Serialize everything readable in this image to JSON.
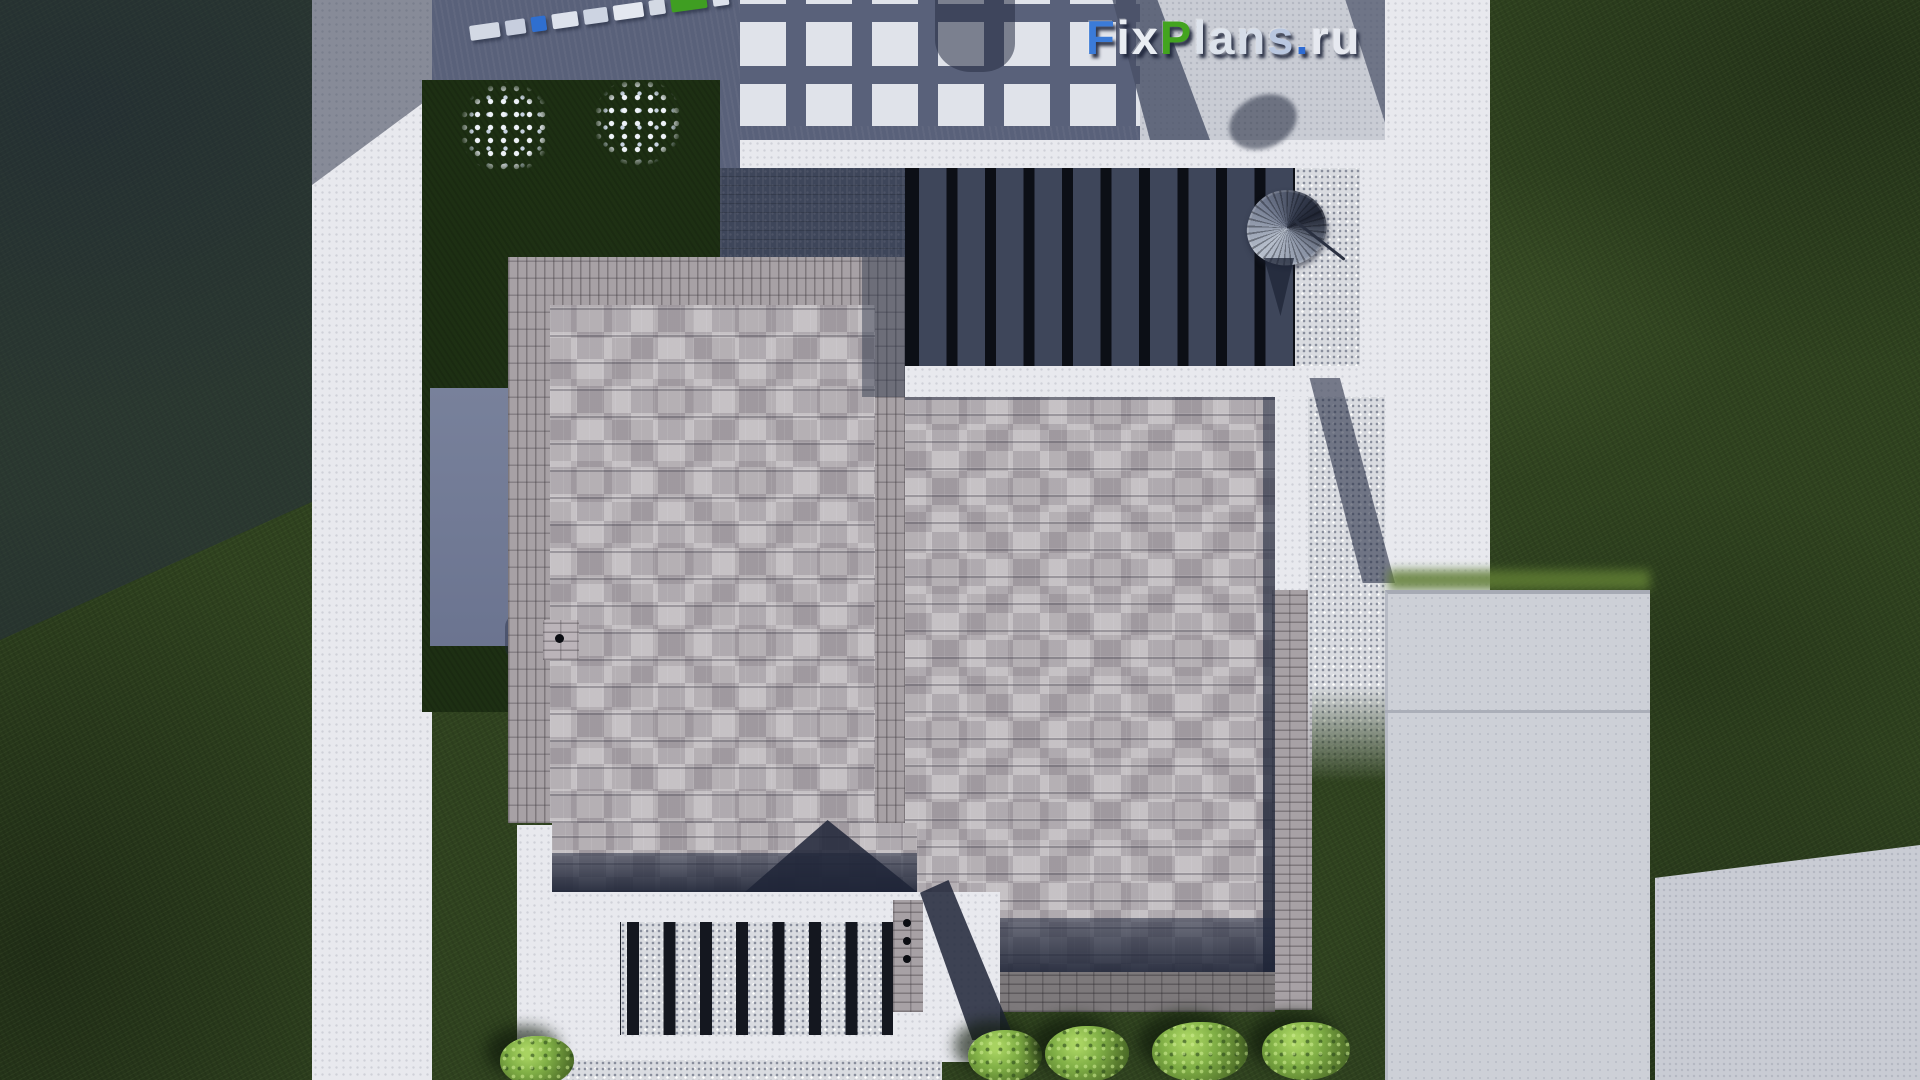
{
  "meta": {
    "description": "Top-down 3D render of a modern flat-roof house plan with pergola terraces, lawns and concrete paths",
    "source_watermark": "FixPlans.ru"
  },
  "watermark": {
    "text": "FixPlans.ru",
    "letters": [
      {
        "ch": "F",
        "color": "#3b7bd8"
      },
      {
        "ch": "i",
        "color": "#e9edf3"
      },
      {
        "ch": "x",
        "color": "#e9edf3"
      },
      {
        "ch": "P",
        "color": "#43a41f"
      },
      {
        "ch": "l",
        "color": "#dde3ec"
      },
      {
        "ch": "a",
        "color": "#dde3ec"
      },
      {
        "ch": "n",
        "color": "#d5dce8"
      },
      {
        "ch": "s",
        "color": "#b9c7e0"
      },
      {
        "ch": ".",
        "color": "#2e6bd2"
      },
      {
        "ch": "r",
        "color": "#e6e9f0"
      },
      {
        "ch": "u",
        "color": "#e6e9f0"
      }
    ],
    "shadow_color": "#1c2238"
  },
  "mini_watermark": {
    "tilt_deg": -8,
    "blocks": [
      {
        "w": 30,
        "color": "#d3d9e4"
      },
      {
        "w": 20,
        "color": "#c7cede"
      },
      {
        "w": 15,
        "color": "#2f6fd0"
      },
      {
        "w": 26,
        "color": "#dde2ec"
      },
      {
        "w": 24,
        "color": "#cdd4e2"
      },
      {
        "w": 30,
        "color": "#e4e8f0"
      },
      {
        "w": 16,
        "color": "#d3d9e4"
      },
      {
        "w": 36,
        "color": "#3f9e22"
      },
      {
        "w": 16,
        "color": "#dde2ec"
      }
    ]
  },
  "palette": {
    "lawn": "#2f421f",
    "lawn_shaded": "#1d2f13",
    "concrete_white": "#e8e9ee",
    "concrete_light": "#c9ccd4",
    "concrete_shadowed": "#59617a",
    "roof_shingle": "#b4afb3",
    "roof_brick_edge": "#a7a1a5",
    "deck_wood": "#3e465a",
    "pergola_slat": "#0c0f16",
    "shadow_navy": "#242b40",
    "bush_green": "#7fae45"
  },
  "scene": {
    "pergola_slat_count": 11,
    "terrace_slat_count": 8,
    "bottom_bush_count": 5,
    "flowering_bush_count": 2,
    "roof_vent_dots": 4
  }
}
